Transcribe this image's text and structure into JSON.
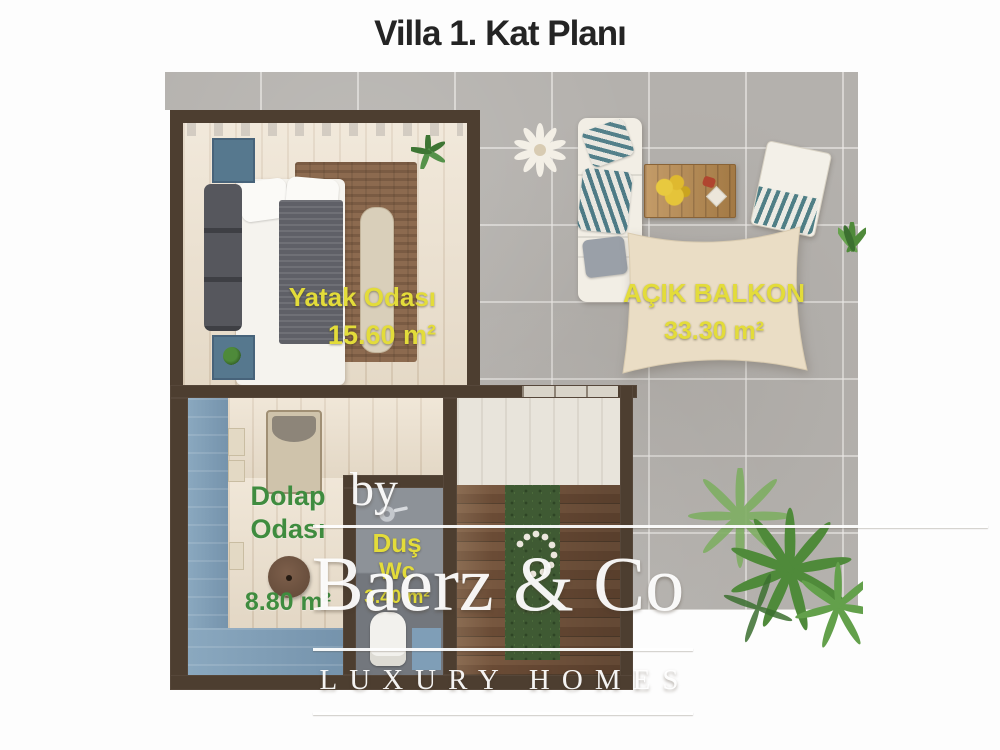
{
  "title": "Villa 1. Kat Planı",
  "rooms": {
    "bedroom": {
      "name": "Yatak Odası",
      "area": "15.60 m²"
    },
    "balcony": {
      "name": "AÇIK BALKON",
      "area": "33.30 m²"
    },
    "closet": {
      "name_line1": "Dolap",
      "name_line2": "Odası",
      "area": "8.80 m²"
    },
    "bath": {
      "name_line1": "Duş",
      "name_line2": "Wc",
      "area": "3.40 m²"
    }
  },
  "watermark": {
    "prefix": "by",
    "brand": "Baerz & Co",
    "tagline": "LUXURY HOMES"
  },
  "colors": {
    "label_yellow": "#e3dc3a",
    "label_green": "#3f8c3f",
    "wall_brown": "#4d3e30",
    "tile_gray": "#b4b1ad",
    "wood_cream": "#ece0cd",
    "stairs_wood": "#6e4f39",
    "pool_blue": "#7f9eb7",
    "canopy_cream": "#eaddc5",
    "bath_gray": "#787d84"
  }
}
